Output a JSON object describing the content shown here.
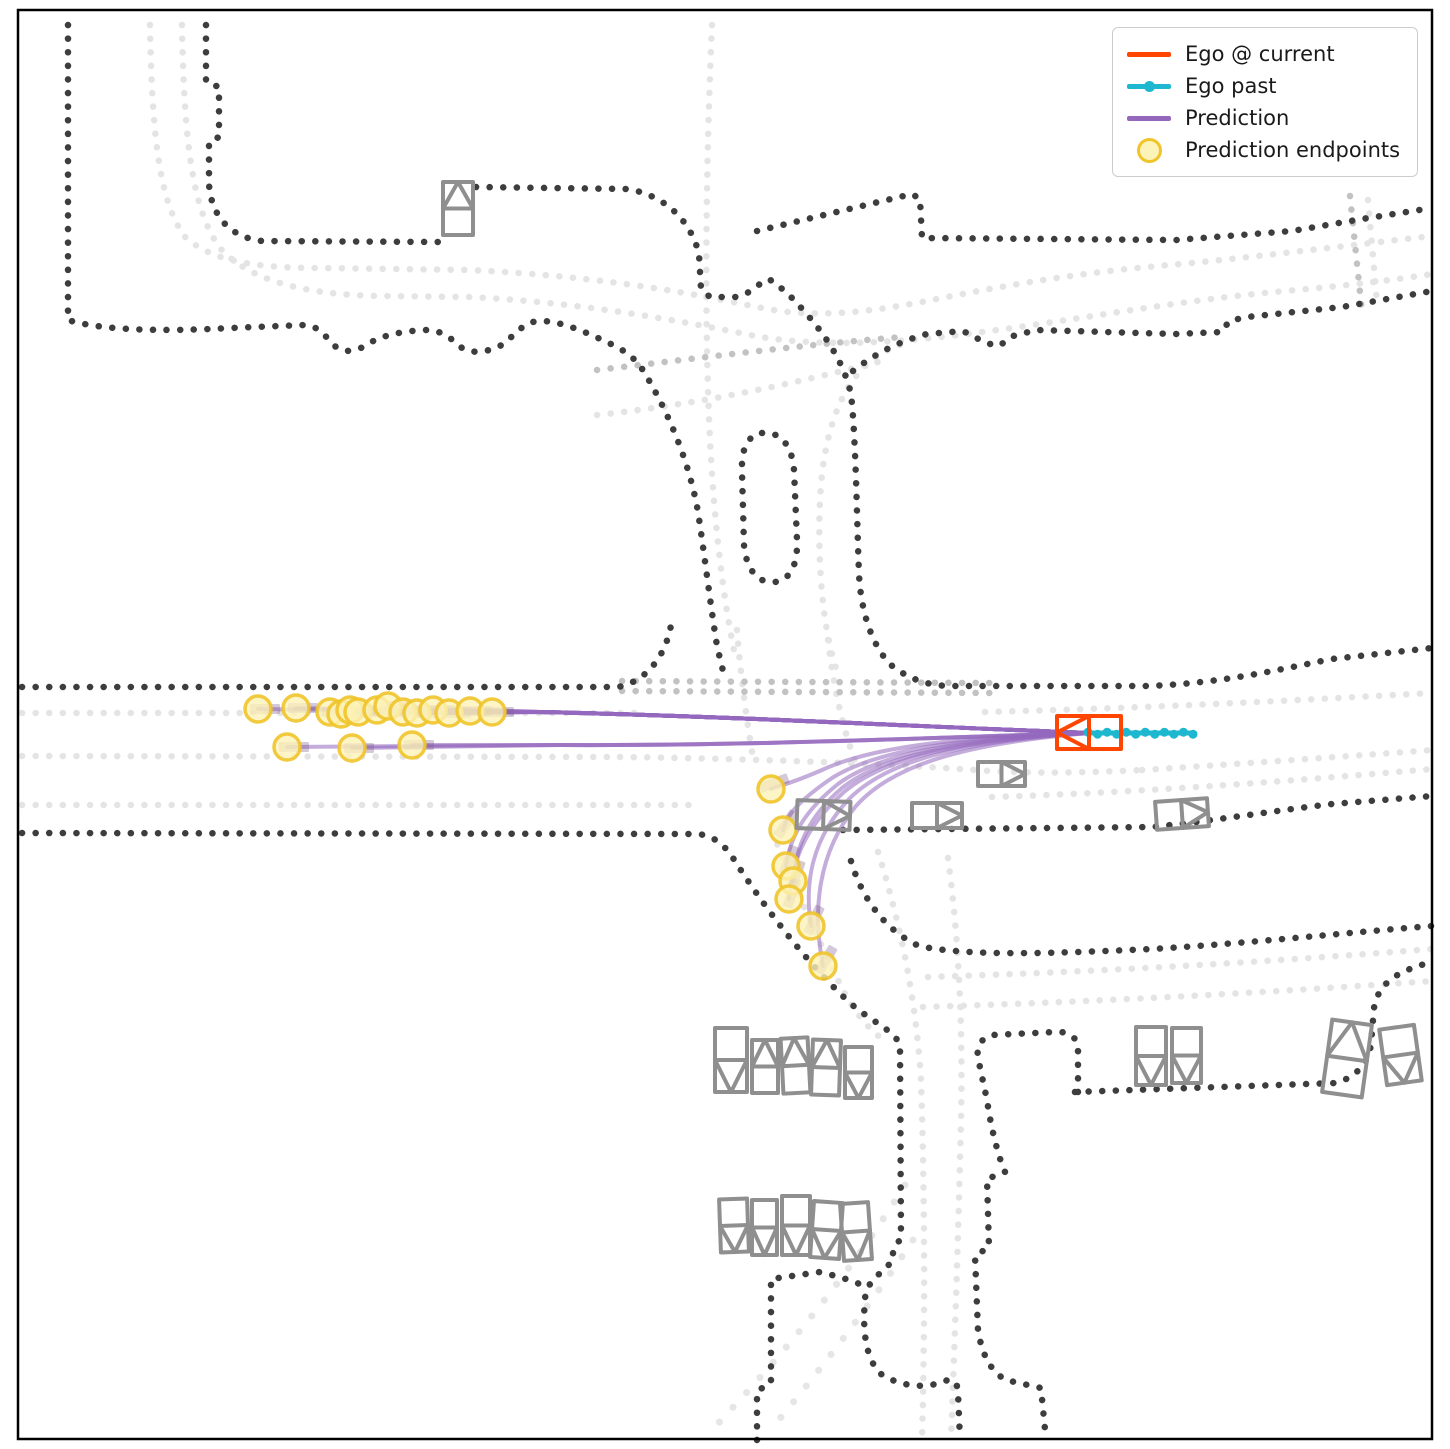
{
  "legend": {
    "items": [
      {
        "label": "Ego @ current",
        "type": "line",
        "color": "#ff4500"
      },
      {
        "label": "Ego past",
        "type": "line-dot",
        "color": "#1db8cf"
      },
      {
        "label": "Prediction",
        "type": "line",
        "color": "#9467bd"
      },
      {
        "label": "Prediction endpoints",
        "type": "circle",
        "fill": "#fcf3b8",
        "edge": "#f0c42a"
      }
    ]
  },
  "chart_data": {
    "type": "line",
    "title": "",
    "description": "Top-down ego-vehicle trajectory prediction over dotted road-map; ego at right center heading west, prediction fan to the west and a left-turn bundle curving south, yellow circles mark prediction endpoints.",
    "canvas": {
      "width": 1450,
      "height": 1449,
      "border": [
        18,
        10,
        1414,
        1429
      ]
    },
    "colors": {
      "ego_current": "#ff4500",
      "ego_past": "#1db8cf",
      "prediction": "#9467bd",
      "endpoint_fill": "#fcf3b8",
      "endpoint_edge": "#f0c42a",
      "vehicle": "#8f8f8f",
      "road_dark": "#3d3d3d",
      "road_mid": "#c2c2c2",
      "road_light": "#e4e4e4"
    },
    "ego_current": {
      "rect": [
        1057,
        716,
        64,
        33
      ],
      "heading": "left"
    },
    "ego_past": {
      "from": [
        1088,
        733
      ],
      "to": [
        1193,
        733
      ],
      "n_dots": 12
    },
    "prediction": {
      "origin": [
        1090,
        733
      ],
      "straight_endpoints": [
        [
          258,
          709
        ],
        [
          296,
          708
        ],
        [
          330,
          712
        ],
        [
          341,
          714
        ],
        [
          350,
          710
        ],
        [
          358,
          712
        ],
        [
          377,
          710
        ],
        [
          388,
          706
        ],
        [
          403,
          712
        ],
        [
          417,
          713
        ],
        [
          433,
          710
        ],
        [
          449,
          713
        ],
        [
          470,
          711
        ],
        [
          492,
          712
        ]
      ],
      "lower_endpoints": [
        [
          287,
          747
        ],
        [
          352,
          748
        ],
        [
          412,
          745
        ]
      ],
      "curved_paths": [
        "M 1090,733 C 940,737 865,750 822,770 C 795,782 779,786 771,789",
        "M 1090,733 C 945,738 872,753 832,778 C 800,800 787,814 783,830",
        "M 1090,733 C 948,739 876,756 838,784 C 803,812 790,838 786,866",
        "M 1090,733 C 950,740 880,758 842,788 C 807,818 796,848 793,881",
        "M 1090,733 C 950,741 882,760 844,792 C 806,826 792,860 789,899",
        "M 1090,733 C 952,742 886,763 850,798 C 812,838 804,882 811,926",
        "M 1090,733 C 955,744 890,768 856,806 C 818,852 812,910 823,966"
      ],
      "curved_endpoints": [
        [
          771,
          789,
          -20
        ],
        [
          783,
          830,
          -55
        ],
        [
          786,
          866,
          -68
        ],
        [
          793,
          881,
          -70
        ],
        [
          789,
          899,
          -72
        ],
        [
          811,
          926,
          -65
        ],
        [
          823,
          966,
          -60
        ]
      ],
      "endpoint_radius": 13
    },
    "vehicles": [
      [
        443,
        182,
        30,
        53,
        "up",
        0
      ],
      [
        978,
        762,
        47,
        24,
        "right",
        0
      ],
      [
        797,
        801,
        53,
        28,
        "right",
        2
      ],
      [
        912,
        803,
        50,
        25,
        "right",
        0
      ],
      [
        1156,
        800,
        52,
        28,
        "right",
        -4
      ],
      [
        715,
        1028,
        32,
        64,
        "down",
        0
      ],
      [
        752,
        1040,
        26,
        53,
        "up",
        0
      ],
      [
        782,
        1038,
        27,
        55,
        "up",
        -3
      ],
      [
        812,
        1040,
        28,
        55,
        "up",
        2
      ],
      [
        845,
        1047,
        27,
        51,
        "down",
        0
      ],
      [
        720,
        1199,
        28,
        53,
        "down",
        -2
      ],
      [
        752,
        1200,
        25,
        55,
        "down",
        0
      ],
      [
        782,
        1196,
        28,
        59,
        "down",
        0
      ],
      [
        812,
        1202,
        29,
        56,
        "down",
        4
      ],
      [
        842,
        1203,
        28,
        57,
        "down",
        -4
      ],
      [
        1136,
        1027,
        30,
        58,
        "down",
        0
      ],
      [
        1172,
        1028,
        29,
        55,
        "down",
        0
      ],
      [
        1327,
        1022,
        40,
        73,
        "up",
        8
      ],
      [
        1383,
        1027,
        35,
        56,
        "down",
        -8
      ]
    ],
    "roads": {
      "dark": [
        "M 68,25 L 68,320 C 100,330 160,332 230,328 L 305,325 C 320,326 326,338 336,347 C 344,353 356,352 368,344 C 382,335 404,331 425,330 C 444,330 452,340 462,348 C 472,354 486,352 498,347 C 512,340 520,323 538,321 C 560,320 588,333 615,346 C 625,351 632,357 639,364 C 666,406 689,460 698,512 C 705,558 710,602 717,646 L 723,671",
        "M 206,25 L 206,82 L 219,87 L 219,137 L 209,142 L 209,184 C 211,214 228,237 262,241 L 441,242",
        "M 476,187 L 628,189 C 667,196 691,222 699,254 L 701,289 L 710,297 L 736,297 C 749,294 754,288 760,284 L 769,279 L 780,287 L 791,297 C 822,329 843,359 851,394 C 856,438 857,528 859,574 C 861,614 873,647 891,665 C 911,681 932,686 952,686 L 1148,686 C 1222,683 1272,671 1332,659 L 1432,648",
        "M 853,371 C 876,353 900,341 927,334 L 963,331 L 986,343 L 999,346 L 1013,336 L 1036,330 L 1176,334 L 1222,332 L 1229,321 L 1247,317 L 1342,307 L 1432,291",
        "M 757,231 L 912,194 L 920,199 L 922,238 L 1176,240 L 1292,231 L 1362,219 L 1432,208",
        "M 762,433 C 780,431 792,445 794,470 L 797,540 C 798,565 790,580 775,582 C 757,584 746,568 744,545 L 742,472 C 741,448 748,435 762,433",
        "M 22,687 L 618,687 C 648,681 666,654 671,625",
        "M 22,833 L 698,834 C 715,836 725,846 733,858 C 763,905 802,958 850,1003 C 872,1022 894,1030 900,1045 L 901,1238 L 893,1250 L 893,1261 C 882,1271 872,1280 866,1290 C 861,1330 866,1360 881,1374 C 901,1387 926,1389 945,1381 C 953,1378 957,1381 958,1392 L 960,1440",
        "M 757,1440 L 757,1391 L 771,1383 L 771,1279 L 820,1272 C 836,1276 852,1280 866,1287",
        "M 843,830 L 1152,827 C 1212,821 1272,811 1332,804 L 1432,796",
        "M 851,861 C 862,899 886,931 919,946 C 971,957 1062,953 1152,949 C 1252,943 1342,933 1432,926",
        "M 1078,1092 L 1078,1049 C 1078,1037 1068,1031 1055,1032 L 993,1035 C 982,1037 976,1046 978,1058 L 987,1100 C 992,1134 998,1152 1002,1165 L 1005,1172 L 987,1179 L 989,1247 L 975,1256 L 978,1330 C 982,1355 991,1372 1006,1380 L 1041,1388 L 1046,1440",
        "M 1075,1092 L 1336,1083 C 1356,1077 1368,1064 1371,1044 L 1374,1008 C 1378,984 1396,971 1432,962"
      ],
      "mid": [
        "M 622,681 L 990,683",
        "M 622,691 L 990,693",
        "M 597,370 C 700,358 800,345 902,337",
        "M 1350,196 L 1362,312"
      ],
      "light": [
        "M 22,713 L 640,713",
        "M 22,756 L 618,757",
        "M 22,805 L 695,805",
        "M 150,25 C 152,140 160,205 186,238 C 214,262 258,268 320,268 L 470,270 C 610,277 700,295 762,308 C 822,320 882,310 942,298 C 1022,282 1102,270 1182,264 C 1272,255 1352,245 1432,236",
        "M 182,25 C 184,140 192,210 220,248 C 250,282 310,295 380,296 L 470,297 C 590,303 690,323 755,336 C 835,350 925,340 1005,329 C 1105,315 1185,300 1285,291 C 1355,285 1400,279 1432,274",
        "M 712,25 C 706,160 704,320 710,440 C 714,520 723,600 736,660",
        "M 900,345 C 848,362 824,420 820,500 C 817,570 824,632 836,668",
        "M 737,630 C 741,680 747,722 753,758",
        "M 828,640 C 834,690 844,736 859,770",
        "M 597,415 C 700,404 792,384 878,362",
        "M 620,757 C 770,759 890,764 990,771 C 1045,774 1100,772 1142,770",
        "M 985,712 C 1152,708 1302,700 1432,693",
        "M 1142,770 C 1252,763 1352,756 1432,750",
        "M 992,797 C 1152,792 1302,780 1432,769",
        "M 772,832 C 794,884 819,943 844,992 C 857,1016 871,1031 885,1041",
        "M 878,852 C 901,925 916,1000 921,1080 C 925,1200 925,1330 922,1440",
        "M 948,858 C 959,940 963,1030 961,1120 C 958,1250 954,1360 951,1440",
        "M 928,977 C 1052,973 1202,967 1432,949",
        "M 923,1007 C 1052,1003 1202,997 1432,981",
        "M 1368,200 L 1377,302"
      ],
      "wide": [
        "M 905,1185 C 856,1264 796,1339 736,1404 L 713,1429",
        "M 913,1240 C 871,1304 821,1369 773,1427"
      ]
    }
  }
}
